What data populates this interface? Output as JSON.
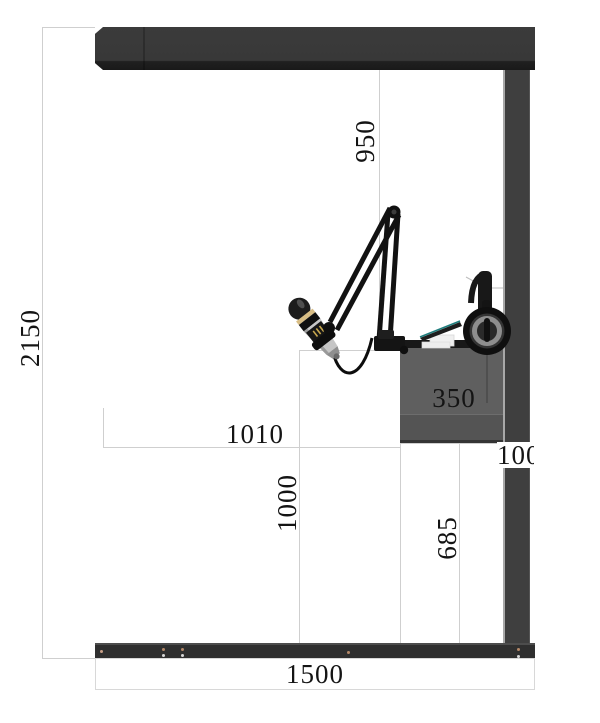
{
  "drawing": {
    "type": "dimensioned side-elevation diagram of a broadcast desk frame",
    "dimensions": {
      "overall_height": "2150",
      "beam_to_desktop": "950",
      "desktop_span": "1010",
      "desktop_height": "1000",
      "under_desk_clearance": "685",
      "desk_panel_height": "350",
      "column_width": "100",
      "base_width": "1500"
    },
    "equipment_icons": {
      "boom_arm": "mic-boom-arm-icon",
      "microphone": "microphone-icon",
      "headphones": "headphones-icon",
      "laptop": "laptop-on-stand-icon"
    },
    "palette": {
      "frame_dark": "#383838",
      "frame_darker": "#191919",
      "desk_gray": "#5f5f5f",
      "dim_line_gray": "#cfcfcf",
      "label_text": "#141414",
      "mic_gold": "#d8bd85",
      "mic_silver": "#c6c6c6",
      "laptop_teal": "#1f7d7d"
    }
  }
}
